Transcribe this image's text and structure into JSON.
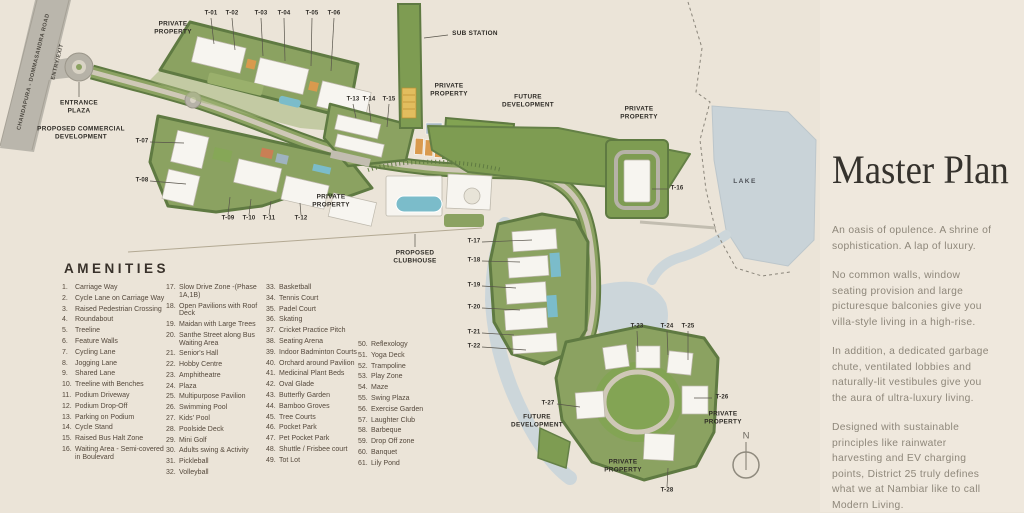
{
  "colors": {
    "background": "#ebe4d8",
    "panel_background": "#efe8dd",
    "parcel_green": "#8ba261",
    "dark_green_border": "#5f7a42",
    "future_dev_green": "#7e9c52",
    "lawn_green": "#83a454",
    "road_gray": "#b6b2a7",
    "lake_blue": "#c9d3d8",
    "pool_blue": "#7bbcca",
    "court_orange": "#d99a4e",
    "label_dark": "#2e2b26",
    "paragraph_gray": "#8e877a"
  },
  "master_plan": {
    "title": "Master Plan",
    "paragraphs": [
      "An oasis of opulence. A shrine of sophistication. A lap of luxury.",
      "No common walls, window seating provision and large picturesque balconies give you villa-style living in a high-rise.",
      "In addition, a dedicated garbage chute, ventilated lobbies and naturally-lit vestibules give you the aura of ultra-luxury living.",
      "Designed with sustainable principles like rainwater harvesting and EV charging points, District 25 truly defines what we at Nambiar like to call Modern Living."
    ]
  },
  "amenities": {
    "title": "AMENITIES",
    "columns": [
      {
        "x": 62,
        "y": 284,
        "w": 104,
        "items": [
          {
            "n": "1.",
            "t": "Carriage Way"
          },
          {
            "n": "2.",
            "t": "Cycle Lane on Carriage Way"
          },
          {
            "n": "3.",
            "t": "Raised Pedestrian Crossing"
          },
          {
            "n": "4.",
            "t": "Roundabout"
          },
          {
            "n": "5.",
            "t": "Treeline"
          },
          {
            "n": "6.",
            "t": "Feature Walls"
          },
          {
            "n": "7.",
            "t": "Cycling Lane"
          },
          {
            "n": "8.",
            "t": "Jogging Lane"
          },
          {
            "n": "9.",
            "t": "Shared Lane"
          },
          {
            "n": "10.",
            "t": "Treeline with Benches"
          },
          {
            "n": "11.",
            "t": "Podium Driveway"
          },
          {
            "n": "12.",
            "t": "Podium Drop-Off"
          },
          {
            "n": "13.",
            "t": "Parking on Podium"
          },
          {
            "n": "14.",
            "t": "Cycle Stand"
          },
          {
            "n": "15.",
            "t": "Raised Bus Halt Zone"
          },
          {
            "n": "16.",
            "t": "Waiting Area - Semi-covered in Boulevard"
          }
        ]
      },
      {
        "x": 166,
        "y": 284,
        "w": 108,
        "items": [
          {
            "n": "17.",
            "t": "Slow Drive Zone -(Phase 1A,1B)"
          },
          {
            "n": "18.",
            "t": "Open Pavilions with Roof Deck"
          },
          {
            "n": "19.",
            "t": "Maidan with Large Trees"
          },
          {
            "n": "20.",
            "t": "Santhe Street along Bus Waiting Area"
          },
          {
            "n": "21.",
            "t": "Senior's Hall"
          },
          {
            "n": "22.",
            "t": "Hobby Centre"
          },
          {
            "n": "23.",
            "t": "Amphitheatre"
          },
          {
            "n": "24.",
            "t": "Plaza"
          },
          {
            "n": "25.",
            "t": "Multipurpose Pavilion"
          },
          {
            "n": "26.",
            "t": "Swimming Pool"
          },
          {
            "n": "27.",
            "t": "Kids' Pool"
          },
          {
            "n": "28.",
            "t": "Poolside Deck"
          },
          {
            "n": "29.",
            "t": "Mini Golf"
          },
          {
            "n": "30.",
            "t": "Adults swing & Activity"
          },
          {
            "n": "31.",
            "t": "Pickleball"
          },
          {
            "n": "32.",
            "t": "Volleyball"
          }
        ]
      },
      {
        "x": 266,
        "y": 284,
        "w": 98,
        "items": [
          {
            "n": "33.",
            "t": "Basketball"
          },
          {
            "n": "34.",
            "t": "Tennis Court"
          },
          {
            "n": "35.",
            "t": "Padel Court"
          },
          {
            "n": "36.",
            "t": "Skating"
          },
          {
            "n": "37.",
            "t": "Cricket Practice Pitch"
          },
          {
            "n": "38.",
            "t": "Seating Arena"
          },
          {
            "n": "39.",
            "t": "Indoor Badminton Courts"
          },
          {
            "n": "40.",
            "t": "Orchard around Pavilion"
          },
          {
            "n": "41.",
            "t": "Medicinal Plant Beds"
          },
          {
            "n": "42.",
            "t": "Oval Glade"
          },
          {
            "n": "43.",
            "t": "Butterfly Garden"
          },
          {
            "n": "44.",
            "t": "Bamboo Groves"
          },
          {
            "n": "45.",
            "t": "Tree Courts"
          },
          {
            "n": "46.",
            "t": "Pocket Park"
          },
          {
            "n": "47.",
            "t": "Pet Pocket Park"
          },
          {
            "n": "48.",
            "t": "Shuttle / Frisbee court"
          },
          {
            "n": "49.",
            "t": "Tot Lot"
          }
        ]
      },
      {
        "x": 358,
        "y": 341,
        "w": 86,
        "items": [
          {
            "n": "50.",
            "t": "Reflexology"
          },
          {
            "n": "51.",
            "t": "Yoga Deck"
          },
          {
            "n": "52.",
            "t": "Trampoline"
          },
          {
            "n": "53.",
            "t": "Play Zone"
          },
          {
            "n": "54.",
            "t": "Maze"
          },
          {
            "n": "55.",
            "t": "Swing Plaza"
          },
          {
            "n": "56.",
            "t": "Exercise Garden"
          },
          {
            "n": "57.",
            "t": "Laughter Club"
          },
          {
            "n": "58.",
            "t": "Barbeque"
          },
          {
            "n": "59.",
            "t": "Drop Off zone"
          },
          {
            "n": "60.",
            "t": "Banquet"
          },
          {
            "n": "61.",
            "t": "Lily Pond"
          }
        ]
      }
    ]
  },
  "map": {
    "labels": [
      {
        "name": "road-name-label",
        "text": "CHANDAPURA - DOMMASANDRA ROAD",
        "x": 34,
        "y": 72,
        "rot": -76,
        "cls": "road"
      },
      {
        "name": "entry-exit-label",
        "text": "ENTRY/EXIT",
        "x": 58,
        "y": 62,
        "rot": -76,
        "cls": "road"
      },
      {
        "name": "private-property-label-1",
        "text": "PRIVATE\nPROPERTY",
        "x": 173,
        "y": 28,
        "cls": "area"
      },
      {
        "name": "sub-station-label",
        "text": "SUB STATION",
        "x": 475,
        "y": 34,
        "cls": "area"
      },
      {
        "name": "private-property-label-2",
        "text": "PRIVATE\nPROPERTY",
        "x": 449,
        "y": 90,
        "cls": "area"
      },
      {
        "name": "future-development-label-1",
        "text": "FUTURE\nDEVELOPMENT",
        "x": 528,
        "y": 101,
        "cls": "area"
      },
      {
        "name": "private-property-label-3",
        "text": "PRIVATE\nPROPERTY",
        "x": 639,
        "y": 113,
        "cls": "area"
      },
      {
        "name": "entrance-plaza-label",
        "text": "ENTRANCE\nPLAZA",
        "x": 79,
        "y": 107,
        "cls": "area"
      },
      {
        "name": "proposed-commercial-development-label",
        "text": "PROPOSED COMMERCIAL\nDEVELOPMENT",
        "x": 81,
        "y": 133,
        "cls": "area"
      },
      {
        "name": "private-property-label-4",
        "text": "PRIVATE\nPROPERTY",
        "x": 331,
        "y": 201,
        "cls": "area"
      },
      {
        "name": "proposed-clubhouse-label",
        "text": "PROPOSED\nCLUBHOUSE",
        "x": 415,
        "y": 257,
        "cls": "area"
      },
      {
        "name": "lake-label",
        "text": "LAKE",
        "x": 745,
        "y": 182,
        "cls": "lake"
      },
      {
        "name": "future-development-label-2",
        "text": "FUTURE\nDEVELOPMENT",
        "x": 537,
        "y": 421,
        "cls": "area"
      },
      {
        "name": "private-property-label-5",
        "text": "PRIVATE\nPROPERTY",
        "x": 723,
        "y": 418,
        "cls": "area"
      },
      {
        "name": "private-property-label-6",
        "text": "PRIVATE\nPROPERTY",
        "x": 623,
        "y": 466,
        "cls": "area"
      },
      {
        "name": "compass-n-label",
        "text": "N",
        "x": 746,
        "y": 436,
        "cls": "compass"
      },
      {
        "name": "tower-label-t01",
        "text": "T-01",
        "x": 211,
        "y": 14,
        "cls": "tower"
      },
      {
        "name": "tower-label-t02",
        "text": "T-02",
        "x": 232,
        "y": 14,
        "cls": "tower"
      },
      {
        "name": "tower-label-t03",
        "text": "T-03",
        "x": 261,
        "y": 14,
        "cls": "tower"
      },
      {
        "name": "tower-label-t04",
        "text": "T-04",
        "x": 284,
        "y": 14,
        "cls": "tower"
      },
      {
        "name": "tower-label-t05",
        "text": "T-05",
        "x": 312,
        "y": 14,
        "cls": "tower"
      },
      {
        "name": "tower-label-t06",
        "text": "T-06",
        "x": 334,
        "y": 14,
        "cls": "tower"
      },
      {
        "name": "tower-label-t07",
        "text": "T-07",
        "x": 142,
        "y": 142,
        "cls": "tower"
      },
      {
        "name": "tower-label-t08",
        "text": "T-08",
        "x": 142,
        "y": 181,
        "cls": "tower"
      },
      {
        "name": "tower-label-t09",
        "text": "T-09",
        "x": 228,
        "y": 219,
        "cls": "tower"
      },
      {
        "name": "tower-label-t10",
        "text": "T-10",
        "x": 249,
        "y": 219,
        "cls": "tower"
      },
      {
        "name": "tower-label-t11",
        "text": "T-11",
        "x": 269,
        "y": 219,
        "cls": "tower"
      },
      {
        "name": "tower-label-t12",
        "text": "T-12",
        "x": 301,
        "y": 219,
        "cls": "tower"
      },
      {
        "name": "tower-label-t13",
        "text": "T-13",
        "x": 353,
        "y": 100,
        "cls": "tower"
      },
      {
        "name": "tower-label-t14",
        "text": "T-14",
        "x": 369,
        "y": 100,
        "cls": "tower"
      },
      {
        "name": "tower-label-t15",
        "text": "T-15",
        "x": 389,
        "y": 100,
        "cls": "tower"
      },
      {
        "name": "tower-label-t16",
        "text": "T-16",
        "x": 677,
        "y": 189,
        "cls": "tower"
      },
      {
        "name": "tower-label-t17",
        "text": "T-17",
        "x": 474,
        "y": 242,
        "cls": "tower"
      },
      {
        "name": "tower-label-t18",
        "text": "T-18",
        "x": 474,
        "y": 261,
        "cls": "tower"
      },
      {
        "name": "tower-label-t19",
        "text": "T-19",
        "x": 474,
        "y": 286,
        "cls": "tower"
      },
      {
        "name": "tower-label-t20",
        "text": "T-20",
        "x": 474,
        "y": 308,
        "cls": "tower"
      },
      {
        "name": "tower-label-t21",
        "text": "T-21",
        "x": 474,
        "y": 333,
        "cls": "tower"
      },
      {
        "name": "tower-label-t22",
        "text": "T-22",
        "x": 474,
        "y": 347,
        "cls": "tower"
      },
      {
        "name": "tower-label-t23",
        "text": "T-23",
        "x": 637,
        "y": 327,
        "cls": "tower"
      },
      {
        "name": "tower-label-t24",
        "text": "T-24",
        "x": 667,
        "y": 327,
        "cls": "tower"
      },
      {
        "name": "tower-label-t25",
        "text": "T-25",
        "x": 688,
        "y": 327,
        "cls": "tower"
      },
      {
        "name": "tower-label-t26",
        "text": "T-26",
        "x": 722,
        "y": 398,
        "cls": "tower"
      },
      {
        "name": "tower-label-t27",
        "text": "T-27",
        "x": 548,
        "y": 404,
        "cls": "tower"
      },
      {
        "name": "tower-label-t28",
        "text": "T-28",
        "x": 667,
        "y": 491,
        "cls": "tower"
      }
    ]
  }
}
